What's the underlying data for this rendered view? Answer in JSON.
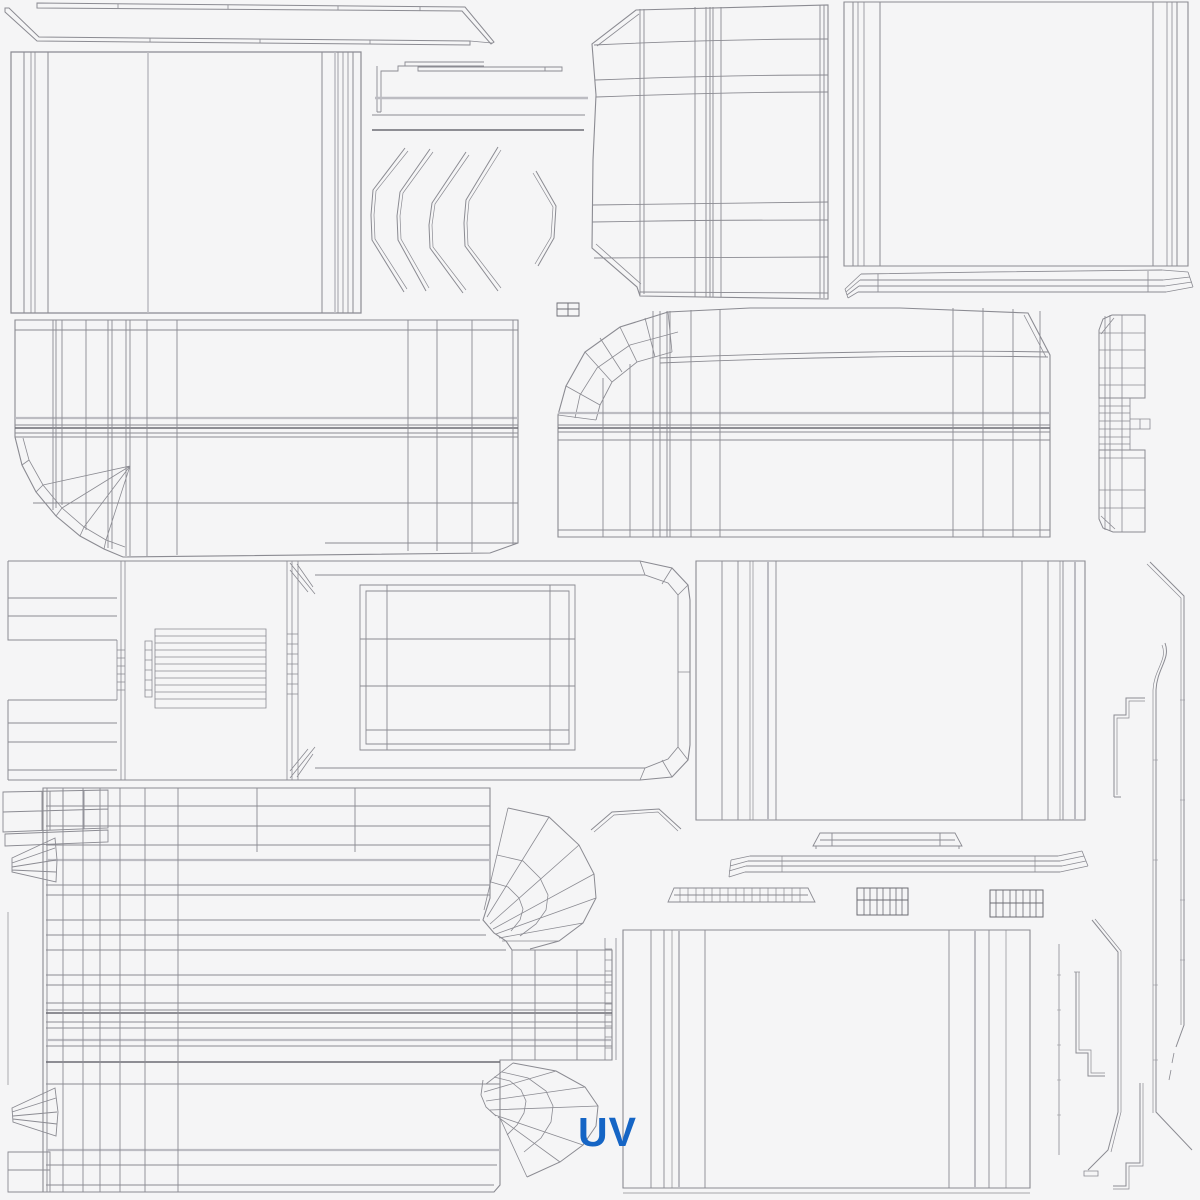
{
  "canvas": {
    "width": 1200,
    "height": 1200,
    "bg": "#f5f5f6"
  },
  "palette": {
    "line": "#8b8b92",
    "dark": "#6d6d74",
    "light": "#bcbcc2",
    "accent": "#1565c5"
  },
  "label": {
    "text": "UV",
    "x": 578,
    "y": 1146,
    "font_size": 41,
    "color": "#1565c5"
  },
  "pieces": [
    {
      "name": "roof-rail-strip-upper",
      "strokes": [
        {
          "d": "M37,3 L465,7 L494,42 L491,44 L462,11 L37,8 Z",
          "w": 1
        },
        {
          "d": "M118,4 V8 M228,5 V9 M338,6 V10 M420,7 V11",
          "w": 0.8
        }
      ]
    },
    {
      "name": "roof-rail-strip-lower",
      "strokes": [
        {
          "d": "M5,8 L9,8 L39,37 L470,41 L470,45 L37,41 L5,12 Z",
          "w": 1
        },
        {
          "d": "M470,41 L492,43 M150,38 V42 M260,39 V43 M370,40 V44",
          "w": 0.8
        }
      ]
    },
    {
      "name": "door-panel-rear",
      "strokes": [
        {
          "d": "M11,52 H361 V313 H11 Z",
          "w": 1.2
        },
        {
          "d": "M24,52 V313 M48,52 V313 M322,52 V313 M353,52 V313",
          "w": 1
        },
        {
          "d": "M31,52 V313 M35,52 V313 M338,52 V313 M343,52 V313 M348,52 V313",
          "w": 0.8
        },
        {
          "d": "M148,52 V313 M335,52 V313",
          "t": "light",
          "w": 1.5
        }
      ]
    },
    {
      "name": "trim-step-bracket",
      "strokes": [
        {
          "d": "M484,62 H405 V66 H398 V71 H381 V112 M377,66 V112 M377,112 H381 M405,66 H484",
          "w": 0.9
        }
      ]
    },
    {
      "name": "trim-sliver",
      "strokes": [
        {
          "d": "M418,67 H562 V71 H418 Z M545,67 V71",
          "w": 0.9
        }
      ]
    },
    {
      "name": "trim-lines",
      "strokes": [
        {
          "d": "M375,98 H588",
          "t": "light",
          "w": 2.5
        },
        {
          "d": "M372,115 H585",
          "w": 0.9
        },
        {
          "d": "M372,130 H584",
          "t": "dark",
          "w": 1.5
        }
      ]
    },
    {
      "name": "fender-arc-strips",
      "strokes": [
        {
          "d": "M405,148 L373,190 L371,215 L372,240 L404,292",
          "w": 1
        },
        {
          "d": "M408,151 L376,191 L374,215 L375,239 L407,289",
          "w": 0.7
        },
        {
          "d": "M430,149 L400,192 L397,216 L398,240 L426,291",
          "w": 1
        },
        {
          "d": "M433,152 L403,193 L400,216 L401,239 L429,288",
          "w": 0.7
        },
        {
          "d": "M466,152 L432,203 L429,225 L430,248 L463,293",
          "w": 1
        },
        {
          "d": "M469,155 L435,204 L432,225 L433,247 L466,290",
          "w": 0.7
        },
        {
          "d": "M498,147 L466,200 L464,223 L465,246 L498,291",
          "w": 1
        },
        {
          "d": "M501,150 L469,201 L467,223 L468,245 L501,288",
          "w": 0.7
        },
        {
          "d": "M536,171 L556,206 L554,238 L538,266",
          "w": 1
        },
        {
          "d": "M533,173 L553,207 L551,237 L535,264",
          "w": 0.7
        }
      ]
    },
    {
      "name": "hood-panel",
      "strokes": [
        {
          "d": "M636,10 L828,5 L828,299 L640,296 L637,287 L592,248 L593,160 L596,95 L592,44 Z",
          "w": 1.1
        },
        {
          "d": "M639,14 L597,46 M596,244 L641,284",
          "w": 0.8
        },
        {
          "d": "M640,9 V295 M644,9 V294 M695,7 V297 M706,7 V297 M710,7 V297 M713,7 V297 M721,7 V297 M820,5 V298 M824,5 V298",
          "w": 0.9
        },
        {
          "d": "M594,45 C700,40 780,39 828,39 M595,80 C700,76 780,75 828,75 M596,97 C700,93 780,92 828,92 M593,205 C700,203 780,202 828,202 M592,222 C700,220 780,220 828,220 M594,258 C700,257 780,257 828,257 M640,292 L828,293",
          "w": 0.9
        }
      ]
    },
    {
      "name": "quarter-panel-right",
      "strokes": [
        {
          "d": "M844,2 H1188 V266 H844 Z",
          "w": 1.1
        },
        {
          "d": "M853,2 V266 M880,2 V266 M1153,2 V266 M1177,2 V266",
          "w": 1
        },
        {
          "d": "M858,2 V266 M864,2 V266 M1167,2 V266 M1172,2 V266",
          "w": 0.8
        }
      ]
    },
    {
      "name": "rocker-strip-right",
      "strokes": [
        {
          "d": "M861,274 C950,272 1100,271 1162,270 M860,280 H1163 M859,286 H1165 M858,292 H1166",
          "w": 0.9
        },
        {
          "d": "M861,274 L845,289 M860,280 L846,292 M859,286 L847,295 M858,292 L848,298 M845,289 L848,298",
          "w": 0.8
        },
        {
          "d": "M1162,270 L1188,272 M1163,280 L1190,277 M1165,286 L1192,282 M1166,292 L1193,287 M1188,272 L1193,287",
          "w": 0.8
        },
        {
          "d": "M878,274 V292 M1148,271 V292",
          "w": 0.8
        }
      ]
    },
    {
      "name": "uv-cell-marker",
      "strokes": [
        {
          "d": "M557,303 H579 V316 H557 Z M568,303 V316 M557,309 H579",
          "w": 0.9,
          "t": "dark"
        }
      ]
    },
    {
      "name": "cargo-side-panel",
      "strokes": [
        {
          "d": "M15,320 H518 V543 L490,553 L123,557 L104,549 L80,536 L56,516 L36,492 L22,465 L15,437 Z",
          "w": 1.1
        },
        {
          "d": "M125,547 L106,540 L84,527 L62,508 L43,485 L29,460 L23,438",
          "w": 0.8
        },
        {
          "d": "M104,549 L106,540 M80,536 L84,527 M56,516 L62,508 M36,492 L43,485 M22,465 L29,460 M106,540 L130,466 M84,527 L130,466 M62,508 L130,466 M43,485 L130,466",
          "w": 0.8
        },
        {
          "d": "M15,330 H518 M15,425 H518 M15,433 H518 M15,437 H518 M33,503 H518 M325,543 H518",
          "w": 0.9
        },
        {
          "d": "M15,418 H518",
          "t": "light",
          "w": 2.2
        },
        {
          "d": "M15,428 H518",
          "t": "dark",
          "w": 1.4
        },
        {
          "d": "M53,320 V510 M56,320 V508 M62,320 V505 M86,320 V530 M108,320 V548 M112,320 V549 M126,320 V556 M130,320 V556 M147,320 V556 M177,320 V555 M408,320 V551 M437,320 V551 M472,320 V552 M513,320 V545",
          "w": 0.9
        }
      ]
    },
    {
      "name": "van-side-upper",
      "strokes": [
        {
          "d": "M668,312 L620,327 L585,352 L566,386 L558,415 L558,537 L1050,537 L1050,355 L1028,313 L900,308 L750,308 Z",
          "w": 1.1
        },
        {
          "d": "M660,358 C800,352 950,350 1048,352 M660,363 C800,357 950,355 1048,357",
          "w": 0.9
        },
        {
          "d": "M672,352 L637,362 L612,382 L600,405 L596,420",
          "w": 0.9
        },
        {
          "d": "M678,332 L630,345 L597,368 L580,395 L575,418",
          "w": 0.8
        },
        {
          "d": "M668,312 L672,352 M620,327 L637,362 M585,352 L612,382 M566,386 L600,405 M558,415 L596,420 M645,318 L655,357 M600,338 L622,372",
          "w": 0.8
        },
        {
          "d": "M558,425 H1050 M558,432 H1050 M558,440 H1050 M558,530 H1050",
          "w": 0.9
        },
        {
          "d": "M558,413 H1050",
          "t": "light",
          "w": 2.2
        },
        {
          "d": "M558,428 H1050",
          "t": "dark",
          "w": 1.4
        },
        {
          "d": "M603,378 V537 M630,364 V537 M653,311 V537 M660,311 V537 M667,311 V537 M670,311 V537 M691,310 V537 M720,309 V537 M953,308 V537 M983,308 V537 M1013,309 V537 M1040,311 V537",
          "w": 0.9
        },
        {
          "d": "M1024,315 L1046,357",
          "w": 0.8
        }
      ]
    },
    {
      "name": "tailgate-ladder",
      "strokes": [
        {
          "d": "M1099,330 L1103,319 L1112,315 L1145,315 L1145,398 L1099,398 Z",
          "w": 1
        },
        {
          "d": "M1105,316 V398 M1110,315 V398 M1122,315 V398 M1099,333 H1145 M1099,350 H1145 M1099,368 H1145 M1099,385 H1145 M1101,334 L1114,318",
          "w": 0.8
        },
        {
          "d": "M1099,398 V450 M1130,398 V450 M1099,406 H1130 M1099,413 H1130 M1099,421 H1130 M1099,429 H1130 M1099,437 H1130 M1099,444 H1130 M1105,398 V450 M1110,398 V450 M1122,398 V450",
          "w": 0.8
        },
        {
          "d": "M1130,419 H1150 V429 H1130 M1140,419 V429",
          "w": 0.8
        },
        {
          "d": "M1099,450 L1145,450 L1145,532 L1113,532 L1103,528 L1099,519 Z",
          "w": 1
        },
        {
          "d": "M1105,450 V530 M1110,450 V531 M1122,450 V532 M1099,458 H1145 M1099,490 H1145 M1099,508 H1145 M1101,516 L1115,529",
          "w": 0.8
        }
      ]
    },
    {
      "name": "cab-roof-plan",
      "strokes": [
        {
          "d": "M8,561 H640 L672,568 L688,585 L690,600 V745 L688,760 L672,777 L640,780 H8",
          "w": 1.1
        },
        {
          "d": "M8,561 V640 H117 M8,598 H117 M8,616 H117 M8,700 H117 M8,700 V780 M8,723 H117 M8,742 H117 M8,770 H117 M8,780 H117",
          "w": 1
        },
        {
          "d": "M117,640 V700 M121,561 V780 M125,561 V780 M117,650 H125 M117,658 H125 M117,666 H125 M117,674 H125 M117,682 H125 M117,690 H125",
          "w": 0.8
        },
        {
          "d": "M287,561 V780 M292,561 V780 M298,561 V780 M287,634 H298 M287,644 H298 M287,654 H298 M287,664 H298 M287,674 H298 M287,684 H298 M287,694 H298",
          "w": 0.8
        },
        {
          "d": "M290,563 L315,594 M290,570 L308,592 M297,564 L313,587 M290,778 L315,747 M290,771 L308,749 M297,777 L313,754",
          "w": 0.8
        },
        {
          "d": "M315,575 H645 L668,583 L678,595 V747 L668,759 L645,768 H315",
          "w": 0.9
        },
        {
          "d": "M640,561 L645,575 M672,568 L662,584 M688,585 L678,595 M640,780 L645,768 M672,777 L662,760 M688,760 L678,747 M690,672 H678",
          "w": 0.8
        },
        {
          "d": "M145,641 H152 V697 H145 Z M155,629 H266 V708 H155 Z M155,636 H266 M155,643 H266 M155,650 H266 M155,657 H266 M155,664 H266 M155,671 H266 M155,678 H266 M155,685 H266 M155,692 H266 M155,699 H266 M145,650 H152 M145,660 H152 M145,670 H152 M145,680 H152 M145,690 H152",
          "w": 0.8
        },
        {
          "d": "M360,585 H575 V750 H360 Z M366,591 H569 V744 H366 Z M387,585 V750 M550,585 V750 M360,639 H575 M360,686 H575 M366,730 H569",
          "w": 0.9
        }
      ]
    },
    {
      "name": "box-side-right",
      "strokes": [
        {
          "d": "M696,561 H1085 V820 H696 Z",
          "w": 1.1
        },
        {
          "d": "M722,561 V820 M738,561 V820 M776,561 V820 M1022,561 V820 M1048,561 V820 M1063,561 V820",
          "w": 0.9
        },
        {
          "d": "M750,561 V820 M753,561 V820 M1060,561 V820",
          "w": 0.7
        },
        {
          "d": "M768,561 V820 M1075,561 V820",
          "t": "light",
          "w": 2
        }
      ]
    },
    {
      "name": "trim-long-right-1",
      "strokes": [
        {
          "d": "M1150,562 L1184,596 V1025 L1176,1047",
          "w": 1
        },
        {
          "d": "M1147,564 L1181,598 V1025",
          "w": 0.7
        },
        {
          "d": "M1174,1053 L1172,1063 M1171,1070 L1169,1080",
          "w": 0.8
        },
        {
          "d": "M1180,700 H1185 M1180,800 H1185 M1180,900 H1185 M1180,960 H1185",
          "w": 0.6
        }
      ]
    },
    {
      "name": "trim-long-right-2",
      "strokes": [
        {
          "d": "M1165,643 C1171,659 1157,668 1156,690 V1112 L1192,1150",
          "w": 1
        },
        {
          "d": "M1162,645 C1168,660 1154,669 1153,690 V1113",
          "w": 0.7
        },
        {
          "d": "M1153,760 H1158 M1153,860 H1158 M1153,985 H1158 M1153,1060 H1158",
          "w": 0.6
        }
      ]
    },
    {
      "name": "trim-step-right",
      "strokes": [
        {
          "d": "M1145,698 H1126 V715 H1114 V797 M1114,797 H1121",
          "w": 1
        },
        {
          "d": "M1145,701 H1129 V718 H1117 V795",
          "w": 0.7
        }
      ]
    },
    {
      "name": "windshield-chevron",
      "strokes": [
        {
          "d": "M591,830 L612,812 L659,809 L681,829",
          "w": 1
        },
        {
          "d": "M594,832 L614,815 L658,812 L678,831",
          "w": 0.7
        }
      ]
    },
    {
      "name": "roof-bar-small",
      "strokes": [
        {
          "d": "M813,846 L820,833 H955 L962,846 Z M820,840 H955 M832,833 V846 M940,833 V846 M816,846 V849 M959,846 V849",
          "w": 0.9
        }
      ]
    },
    {
      "name": "bumper-bar",
      "strokes": [
        {
          "d": "M750,856 H1058 M748,861 H1060 M746,866 H1062 M745,872 H1060",
          "w": 0.9
        },
        {
          "d": "M750,856 L731,860 M748,861 L730,866 M746,866 L729,871 M745,872 L729,877 M731,860 L729,877",
          "w": 0.8
        },
        {
          "d": "M1058,856 L1082,851 M1060,861 L1084,856 M1062,866 L1086,861 M1060,872 L1088,866 M1082,851 L1088,866",
          "w": 0.8
        },
        {
          "d": "M782,856 V872 M1035,856 V872",
          "w": 0.7
        }
      ]
    },
    {
      "name": "vent-strip",
      "strokes": [
        {
          "d": "M668,902 L674,888 H808 L815,902 Z M674,895 H808",
          "w": 0.9
        },
        {
          "d": "M680,888 V902 M688,888 V902 M696,888 V902 M704,888 V902 M712,888 V902 M720,888 V902 M728,888 V902 M736,888 V902 M744,888 V902 M752,888 V902 M760,888 V902 M768,888 V902 M776,888 V902 M784,888 V902 M792,888 V902 M800,888 V902",
          "w": 0.7
        }
      ]
    },
    {
      "name": "grid-block-1",
      "strokes": [
        {
          "d": "M857,888 H908 V915 H857 Z M857,900 H908",
          "w": 1,
          "t": "dark"
        },
        {
          "d": "M864,888 V915 M870,888 V915 M877,888 V915 M883,888 V915 M890,888 V915 M896,888 V915 M902,888 V915",
          "w": 0.8,
          "t": "dark"
        }
      ]
    },
    {
      "name": "grid-block-2",
      "strokes": [
        {
          "d": "M990,890 H1043 V917 H990 Z M990,903 H1043",
          "w": 1,
          "t": "dark"
        },
        {
          "d": "M996,890 V917 M1003,890 V917 M1010,890 V917 M1016,890 V917 M1023,890 V917 M1030,890 V917 M1036,890 V917",
          "w": 0.8,
          "t": "dark"
        }
      ]
    },
    {
      "name": "tarp-side-panel",
      "strokes": [
        {
          "d": "M55,788 H490 V898 L483,920 L494,933 L506,941 L512,950 H612 V1060 H500 V1185 L494,1192 H43 V788 Z",
          "w": 1.1
        },
        {
          "d": "M47,788 V1192",
          "w": 0.9
        },
        {
          "d": "M46,806 H490 M46,826 H490 M46,845 H490 M46,885 H490 M46,895 H490 M46,920 H480 M46,935 H486 M46,950 H506 M46,975 H612 M46,985 H612 M46,1003 H612 M46,1010 H612 M46,1022 H612 M46,1028 H612 M46,1046 H612 M46,1084 H500 M46,1165 H497 M46,1185 H494",
          "w": 0.9
        },
        {
          "d": "M46,860 H490 M46,1040 H612 M46,1150 H500",
          "t": "light",
          "w": 2.2
        },
        {
          "d": "M46,1013 H612 M46,1062 H500",
          "t": "dark",
          "w": 1.4
        },
        {
          "d": "M63,788 V1192 M83,788 V1192 M100,788 V1192 M120,788 V1192 M145,788 V1192 M178,788 V1192 M257,788 V852 M355,788 V852",
          "w": 0.9
        },
        {
          "d": "M512,950 V1060 M535,950 V1060 M577,950 V1060",
          "w": 0.9
        },
        {
          "d": "M605,938 V1060 M616,938 V1060 M605,949 H612 M605,960 H612 M605,971 H612 M605,982 H612 M605,993 H612 M605,1004 H612 M605,1015 H612 M605,1026 H612 M605,1037 H612 M605,1048 H612",
          "w": 0.8
        },
        {
          "d": "M3,792 L108,790 V828 L3,832 Z M3,812 L108,809 M42,791 V830 M50,791 V830 M63,791 V829 M84,790 V829 M5,834 L108,830 L108,842 L5,846 Z",
          "w": 0.9
        },
        {
          "d": "M12,858 L55,838 L57,860 L56,882 L12,872 Z M12,863 L55,848 M12,867 L56,860 M12,870 L56,872",
          "w": 0.9
        },
        {
          "d": "M12,1108 L55,1088 L58,1112 L56,1136 L13,1122 Z M12,1112 L56,1098 M13,1116 L57,1112 M13,1119 L57,1124",
          "w": 0.9
        },
        {
          "d": "M8,1152 H50 V1192 H8 Z M8,1170 H50",
          "w": 0.9
        },
        {
          "d": "M8,912 V1085",
          "w": 0.7
        }
      ]
    },
    {
      "name": "wheel-fan-1",
      "strokes": [
        {
          "d": "M508,808 L549,817 L579,845 L594,874 L596,898 L583,923 L559,941 L530,949",
          "w": 1
        },
        {
          "d": "M508,808 L484,910 M549,817 L487,917 M579,845 L490,924 M594,874 L493,929 M596,898 L496,934 M583,923 L499,938 M559,941 L502,941",
          "w": 0.8
        },
        {
          "d": "M497,855 L523,861 L540,878 L548,895 L546,910 L536,924 L520,936 M491,882 L508,887 L519,898 L523,909 L520,920 L511,931",
          "w": 0.8
        }
      ]
    },
    {
      "name": "wheel-fan-2",
      "strokes": [
        {
          "d": "M513,1063 L556,1071 L585,1087 L598,1106 L596,1126 L583,1145 L560,1162 L527,1177",
          "w": 1
        },
        {
          "d": "M483,1080 L481,1095 L486,1107 L496,1116",
          "w": 0.9
        },
        {
          "d": "M513,1063 L486,1084 M556,1071 L484,1092 M585,1087 L486,1101 M598,1106 L490,1110 M583,1145 L495,1115 M560,1162 L498,1117 M527,1177 L500,1118",
          "w": 0.8
        },
        {
          "d": "M502,1072 L528,1078 L546,1091 L553,1106 L551,1122 L541,1138 L524,1152 M494,1077 L510,1081 L521,1090 L526,1101 L524,1113 L517,1125 L507,1135",
          "w": 0.8
        }
      ]
    },
    {
      "name": "bottom-panel",
      "strokes": [
        {
          "d": "M623,930 H1030 V1188 H623 Z",
          "w": 1.1
        },
        {
          "d": "M651,930 V1188 M664,930 V1188 M705,930 V1188 M949,930 V1188 M989,930 V1188",
          "w": 0.9
        },
        {
          "d": "M672,930 V1188 M1006,930 V1188",
          "w": 0.7
        },
        {
          "d": "M679,930 V1188 M975,930 V1188",
          "t": "light",
          "w": 2
        },
        {
          "d": "M623,1193 H1030",
          "w": 0.7
        }
      ]
    },
    {
      "name": "tick-line",
      "strokes": [
        {
          "d": "M1059,944 V1155",
          "w": 0.8
        },
        {
          "d": "M1057,975 H1061 M1057,1010 H1061 M1057,1045 H1061 M1057,1080 H1061 M1057,1115 H1061",
          "w": 0.6
        }
      ]
    },
    {
      "name": "step-piece-a",
      "strokes": [
        {
          "d": "M1076,972 V1053 H1088 V1076 H1105",
          "w": 1
        },
        {
          "d": "M1079,972 V1050 H1091 V1073 H1105",
          "w": 0.7
        },
        {
          "d": "M1074,972 H1080",
          "w": 0.7
        }
      ]
    },
    {
      "name": "long-bracket",
      "strokes": [
        {
          "d": "M1092,920 L1118,952 V1112 L1108,1150 L1088,1170",
          "w": 1
        },
        {
          "d": "M1095,919 L1121,951 V1112 L1111,1152",
          "w": 0.7
        },
        {
          "d": "M1084,1171 H1098 V1176 H1084 Z",
          "w": 0.8
        }
      ]
    },
    {
      "name": "step-piece-b",
      "strokes": [
        {
          "d": "M1140,1083 V1163 H1126 V1186 H1113",
          "w": 1
        },
        {
          "d": "M1143,1083 V1166 H1129 V1189 H1113",
          "w": 0.7
        }
      ]
    }
  ]
}
